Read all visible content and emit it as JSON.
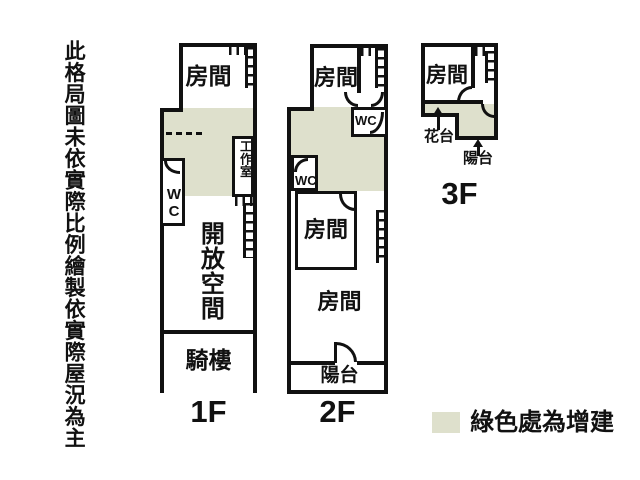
{
  "colors": {
    "wall": "#111111",
    "addition": "#dee0cc",
    "background": "#ffffff"
  },
  "disclaimer": "此格局圖未依實際比例繪製依實際屋況為主",
  "floor1": {
    "label": "1F",
    "room": "房間",
    "wc": "WC",
    "studio": "工作室",
    "open_space": "開放空間",
    "arcade": "騎樓"
  },
  "floor2": {
    "label": "2F",
    "room_top": "房間",
    "wc_top": "WC",
    "wc_mid": "WC",
    "room_mid": "房間",
    "room_bottom": "房間",
    "balcony": "陽台"
  },
  "floor3": {
    "label": "3F",
    "room": "房間",
    "flower_bed": "花台",
    "balcony": "陽台"
  },
  "legend": {
    "text": "綠色處為增建",
    "swatch_color": "#dee0cc"
  }
}
